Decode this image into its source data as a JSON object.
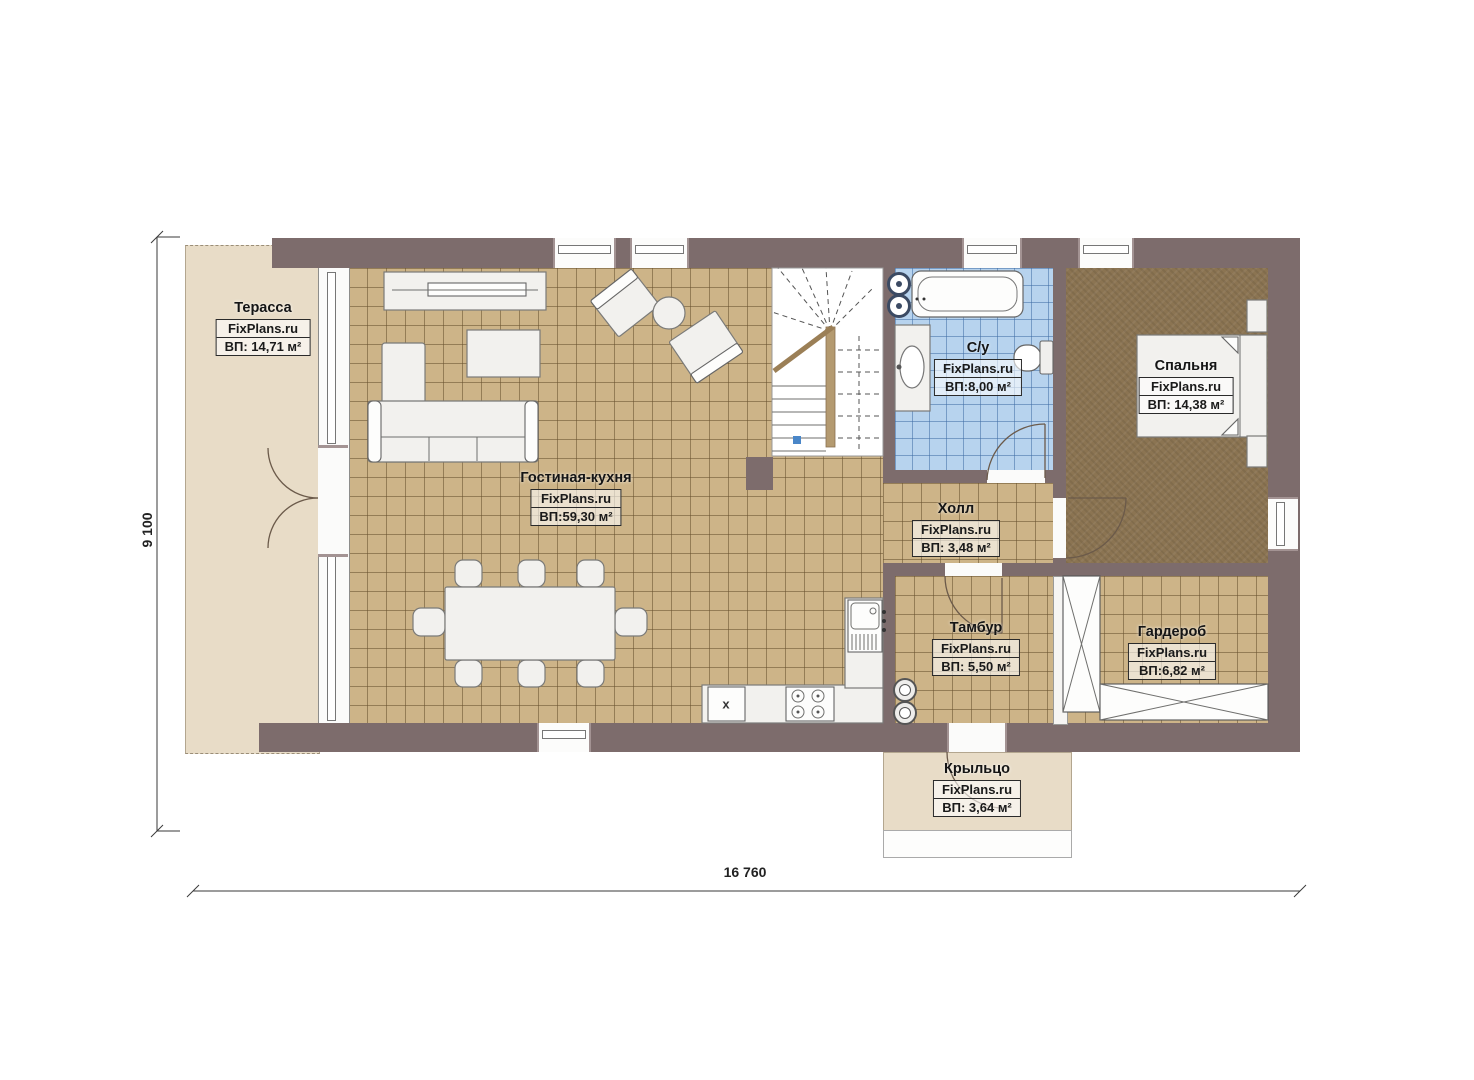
{
  "plan": {
    "title": "floor-plan",
    "brand": "FixPlans.ru",
    "rooms": [
      {
        "id": "terrace",
        "name": "Терасса",
        "brand": "FixPlans.ru",
        "area": "ВП: 14,71 м²"
      },
      {
        "id": "living",
        "name": "Гостиная-кухня",
        "brand": "FixPlans.ru",
        "area": "ВП:59,30 м²"
      },
      {
        "id": "bathroom",
        "name": "С/у",
        "brand": "FixPlans.ru",
        "area": "ВП:8,00 м²"
      },
      {
        "id": "bedroom",
        "name": "Спальня",
        "brand": "FixPlans.ru",
        "area": "ВП: 14,38 м²"
      },
      {
        "id": "hall",
        "name": "Холл",
        "brand": "FixPlans.ru",
        "area": "ВП: 3,48 м²"
      },
      {
        "id": "tambur",
        "name": "Тамбур",
        "brand": "FixPlans.ru",
        "area": "ВП: 5,50 м²"
      },
      {
        "id": "wardrobe",
        "name": "Гардероб",
        "brand": "FixPlans.ru",
        "area": "ВП:6,82 м²"
      },
      {
        "id": "porch",
        "name": "Крыльцо",
        "brand": "FixPlans.ru",
        "area": "ВП: 3,64 м²"
      }
    ],
    "dimensions": {
      "height_label": "9 100",
      "width_label": "16 760"
    },
    "markers": {
      "cabinet_x": "х"
    },
    "colors": {
      "wall": "#7d6c6c",
      "tile": "#cdb488",
      "blue": "#b7d3ee",
      "carpet": "#8b7452",
      "terrace": "#e8dcc7",
      "stair-dot": "#4a86c8"
    }
  }
}
